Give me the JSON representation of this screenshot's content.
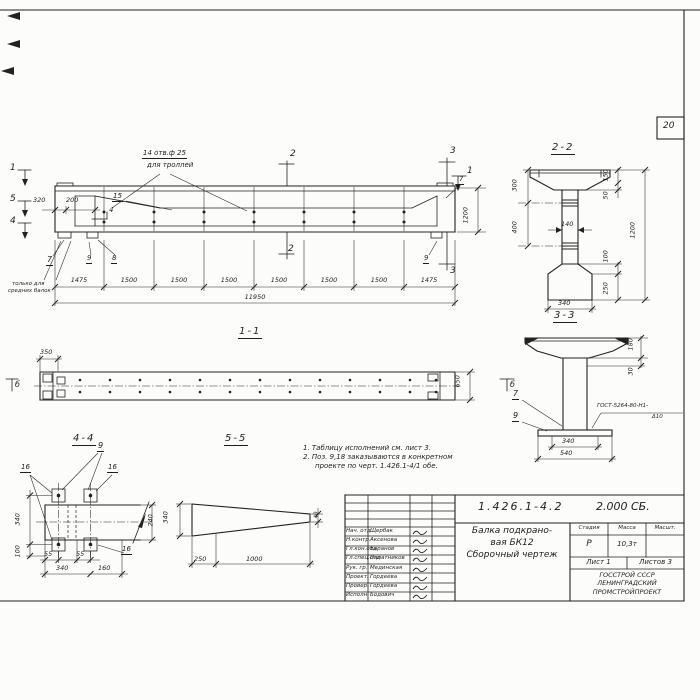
{
  "sheet": {
    "page_number": "20"
  },
  "notes": {
    "line1": "1. Таблицу исполнений см. лист 3.",
    "line2": "2. Поз. 9,18 заказываются в конкретном",
    "line3": "проекте по черт. 1.426.1-4/1 обе."
  },
  "main_view": {
    "hole_note_line1": "14 отв.ф 25",
    "hole_note_line2": "для троллей",
    "marker_1": "1",
    "marker_2": "2",
    "marker_3": "3",
    "marker_4": "4",
    "marker_5": "5",
    "dim_320": "320",
    "dim_200": "200",
    "dim_1200": "1200",
    "pos_4": "4",
    "pos_7": "7",
    "pos_8": "8",
    "pos_9": "9",
    "pos_15": "15",
    "middle_note_line1": "только для",
    "middle_note_line2": "средних балок",
    "chain": [
      "1475",
      "1500",
      "1500",
      "1500",
      "1500",
      "1500",
      "1500",
      "1475"
    ],
    "total": "11950"
  },
  "section_2_2": {
    "title": "2-2",
    "dim_300": "300",
    "dim_400": "400",
    "dim_150": "150",
    "dim_50": "50",
    "dim_140": "140",
    "dim_1200": "1200",
    "dim_100": "100",
    "dim_250": "250",
    "dim_340": "340"
  },
  "section_3_3": {
    "title": "3-3",
    "dim_180": "180",
    "dim_30": "30",
    "pos_7": "7",
    "pos_9": "9",
    "weld_line1": "ГОСТ-5264-80-Н1-",
    "weld_line2": "Δ10",
    "dim_340": "340",
    "dim_540": "540"
  },
  "view_1_1": {
    "title": "1-1",
    "dim_350": "350",
    "dim_650": "650",
    "marker_b": "б"
  },
  "section_4_4": {
    "title": "4-4",
    "pos_9": "9",
    "pos_16": "16",
    "dim_340_left": "340",
    "dim_100": "100",
    "dim_240": "240",
    "dim_55": "55",
    "dim_340_bottom": "340",
    "dim_160": "160"
  },
  "section_5_5": {
    "title": "5-5",
    "dim_340": "340",
    "dim_40": "40",
    "dim_250": "250",
    "dim_1000": "1000"
  },
  "title_block": {
    "doc_number": "1.426.1-4.2",
    "doc_code": "2.000 СБ.",
    "product_line1": "Балка подкрано-",
    "product_line2": "вая БК12",
    "product_line3": "Сборочный чертеж",
    "col_stage": "Стадия",
    "col_mass": "Масса",
    "col_scale": "Масшт.",
    "stage_value": "Р",
    "mass_value": "10,3т",
    "sheet_label": "Лист 1",
    "sheets_label": "Листов 3",
    "org_line1": "ГОССТРОЙ СССР",
    "org_line2": "ЛЕНИНГРАДСКИЙ",
    "org_line3": "ПРОМСТРОЙПРОЕКТ",
    "rows": [
      {
        "role": "Нач. отд",
        "name": "Щербак"
      },
      {
        "role": "Н.контр.",
        "name": "Аксенова"
      },
      {
        "role": "Гл.кон.отд",
        "name": "Баранов"
      },
      {
        "role": "Гл.спец.отд",
        "name": "Палатников"
      },
      {
        "role": "Рук. гр.",
        "name": "Мединская"
      },
      {
        "role": "Проект.",
        "name": "Гордеева"
      },
      {
        "role": "Провер.",
        "name": "Гордеева"
      },
      {
        "role": "Исполн.",
        "name": "Бодович"
      }
    ]
  }
}
